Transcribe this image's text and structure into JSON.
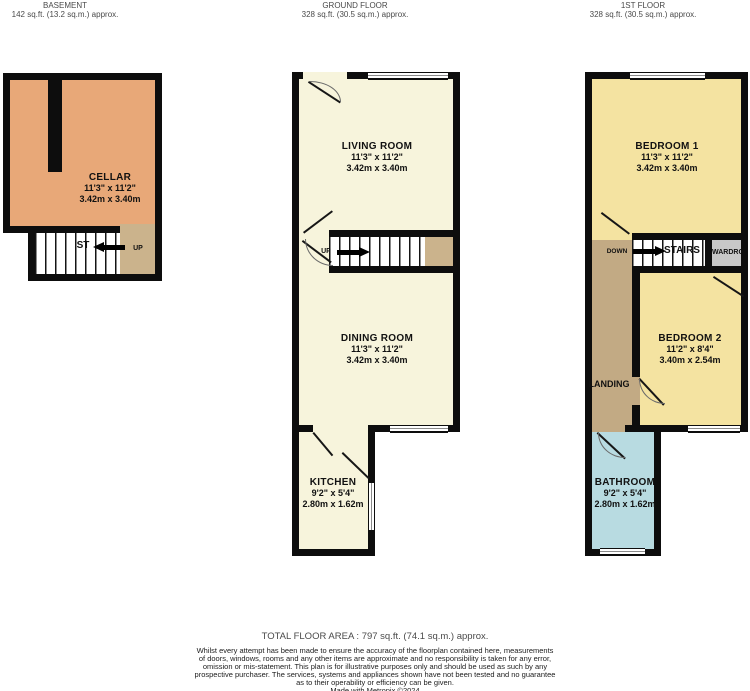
{
  "colors": {
    "wall": "#0d0d0d",
    "cellar_orange": "#e8a878",
    "stair_tan": "#cbb38c",
    "ground_cream": "#f7f4dc",
    "first_yellow": "#f4e3a1",
    "landing_brown": "#c2aa84",
    "bathroom_blue": "#b8dbe1",
    "wardrobe_gray": "#c8c8c8"
  },
  "header": {
    "basement_title": "BASEMENT",
    "basement_area": "142 sq.ft. (13.2 sq.m.) approx.",
    "ground_title": "GROUND FLOOR",
    "ground_area": "328 sq.ft. (30.5 sq.m.) approx.",
    "first_title": "1ST FLOOR",
    "first_area": "328 sq.ft. (30.5 sq.m.) approx."
  },
  "basement": {
    "cellar_name": "CELLAR",
    "cellar_imperial": "11'3\" x 11'2\"",
    "cellar_metric": "3.42m x 3.40m",
    "stairs_label": "ST",
    "up_label": "UP"
  },
  "ground": {
    "living_name": "LIVING ROOM",
    "living_imperial": "11'3\" x 11'2\"",
    "living_metric": "3.42m x 3.40m",
    "up_label": "UP",
    "dining_name": "DINING ROOM",
    "dining_imperial": "11'3\" x 11'2\"",
    "dining_metric": "3.42m x 3.40m",
    "kitchen_name": "KITCHEN",
    "kitchen_imperial": "9'2\" x 5'4\"",
    "kitchen_metric": "2.80m x 1.62m"
  },
  "first": {
    "bedroom1_name": "BEDROOM 1",
    "bedroom1_imperial": "11'3\" x 11'2\"",
    "bedroom1_metric": "3.42m x 3.40m",
    "down_label": "DOWN",
    "stairs_label": "STAIRS",
    "wardrobe_label": "WARDROBE",
    "landing_label": "LANDING",
    "bedroom2_name": "BEDROOM 2",
    "bedroom2_imperial": "11'2\" x 8'4\"",
    "bedroom2_metric": "3.40m x 2.54m",
    "bathroom_name": "BATHROOM",
    "bathroom_imperial": "9'2\" x 5'4\"",
    "bathroom_metric": "2.80m x 1.62m"
  },
  "footer": {
    "total_area": "TOTAL FLOOR AREA : 797 sq.ft. (74.1 sq.m.) approx.",
    "disclaimer_lines": [
      "Whilst every attempt has been made to ensure the accuracy of the floorplan contained here, measurements",
      "of doors, windows, rooms and any other items are approximate and no responsibility is taken for any error,",
      "omission or mis-statement. This plan is for illustrative purposes only and should be used as such by any",
      "prospective purchaser. The services, systems and appliances shown have not been tested and no guarantee",
      "as to their operability or efficiency can be given.",
      "Made with Metropix ©2024"
    ]
  }
}
